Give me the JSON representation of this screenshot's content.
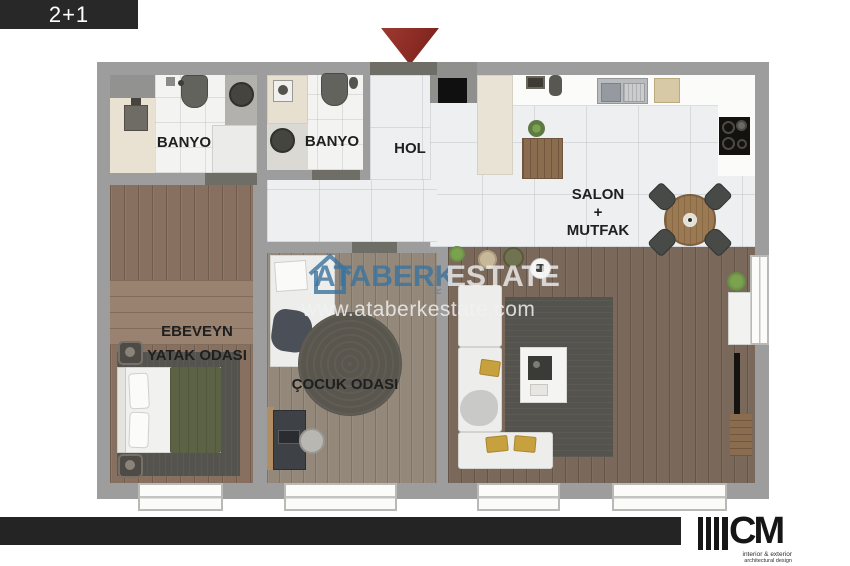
{
  "badge": {
    "label": "2+1"
  },
  "plan": {
    "rooms": {
      "banyo1": {
        "label": "BANYO"
      },
      "banyo2": {
        "label": "BANYO"
      },
      "hol": {
        "label": "HOL"
      },
      "salon_mutfak": {
        "line1": "SALON",
        "line2": "+",
        "line3": "MUTFAK"
      },
      "ebeveyn": {
        "line1": "EBEVEYN",
        "line2": "YATAK ODASI"
      },
      "cocuk": {
        "label": "ÇOCUK ODASI"
      }
    }
  },
  "watermark": {
    "brand": "ATABERK",
    "vertical": "REAL",
    "brand2": "ESTATE",
    "url": "www.ataberkestate.com",
    "brand_color": "#3b739e"
  },
  "footer": {
    "monogram": "CM",
    "tagline1": "interior & exterior",
    "tagline2": "architectural design"
  },
  "colors": {
    "entrance_arrow": "#8a2b24",
    "wall_gray": "#9d9d9d",
    "badge_bg": "#282828",
    "footer_bar": "#242424"
  }
}
